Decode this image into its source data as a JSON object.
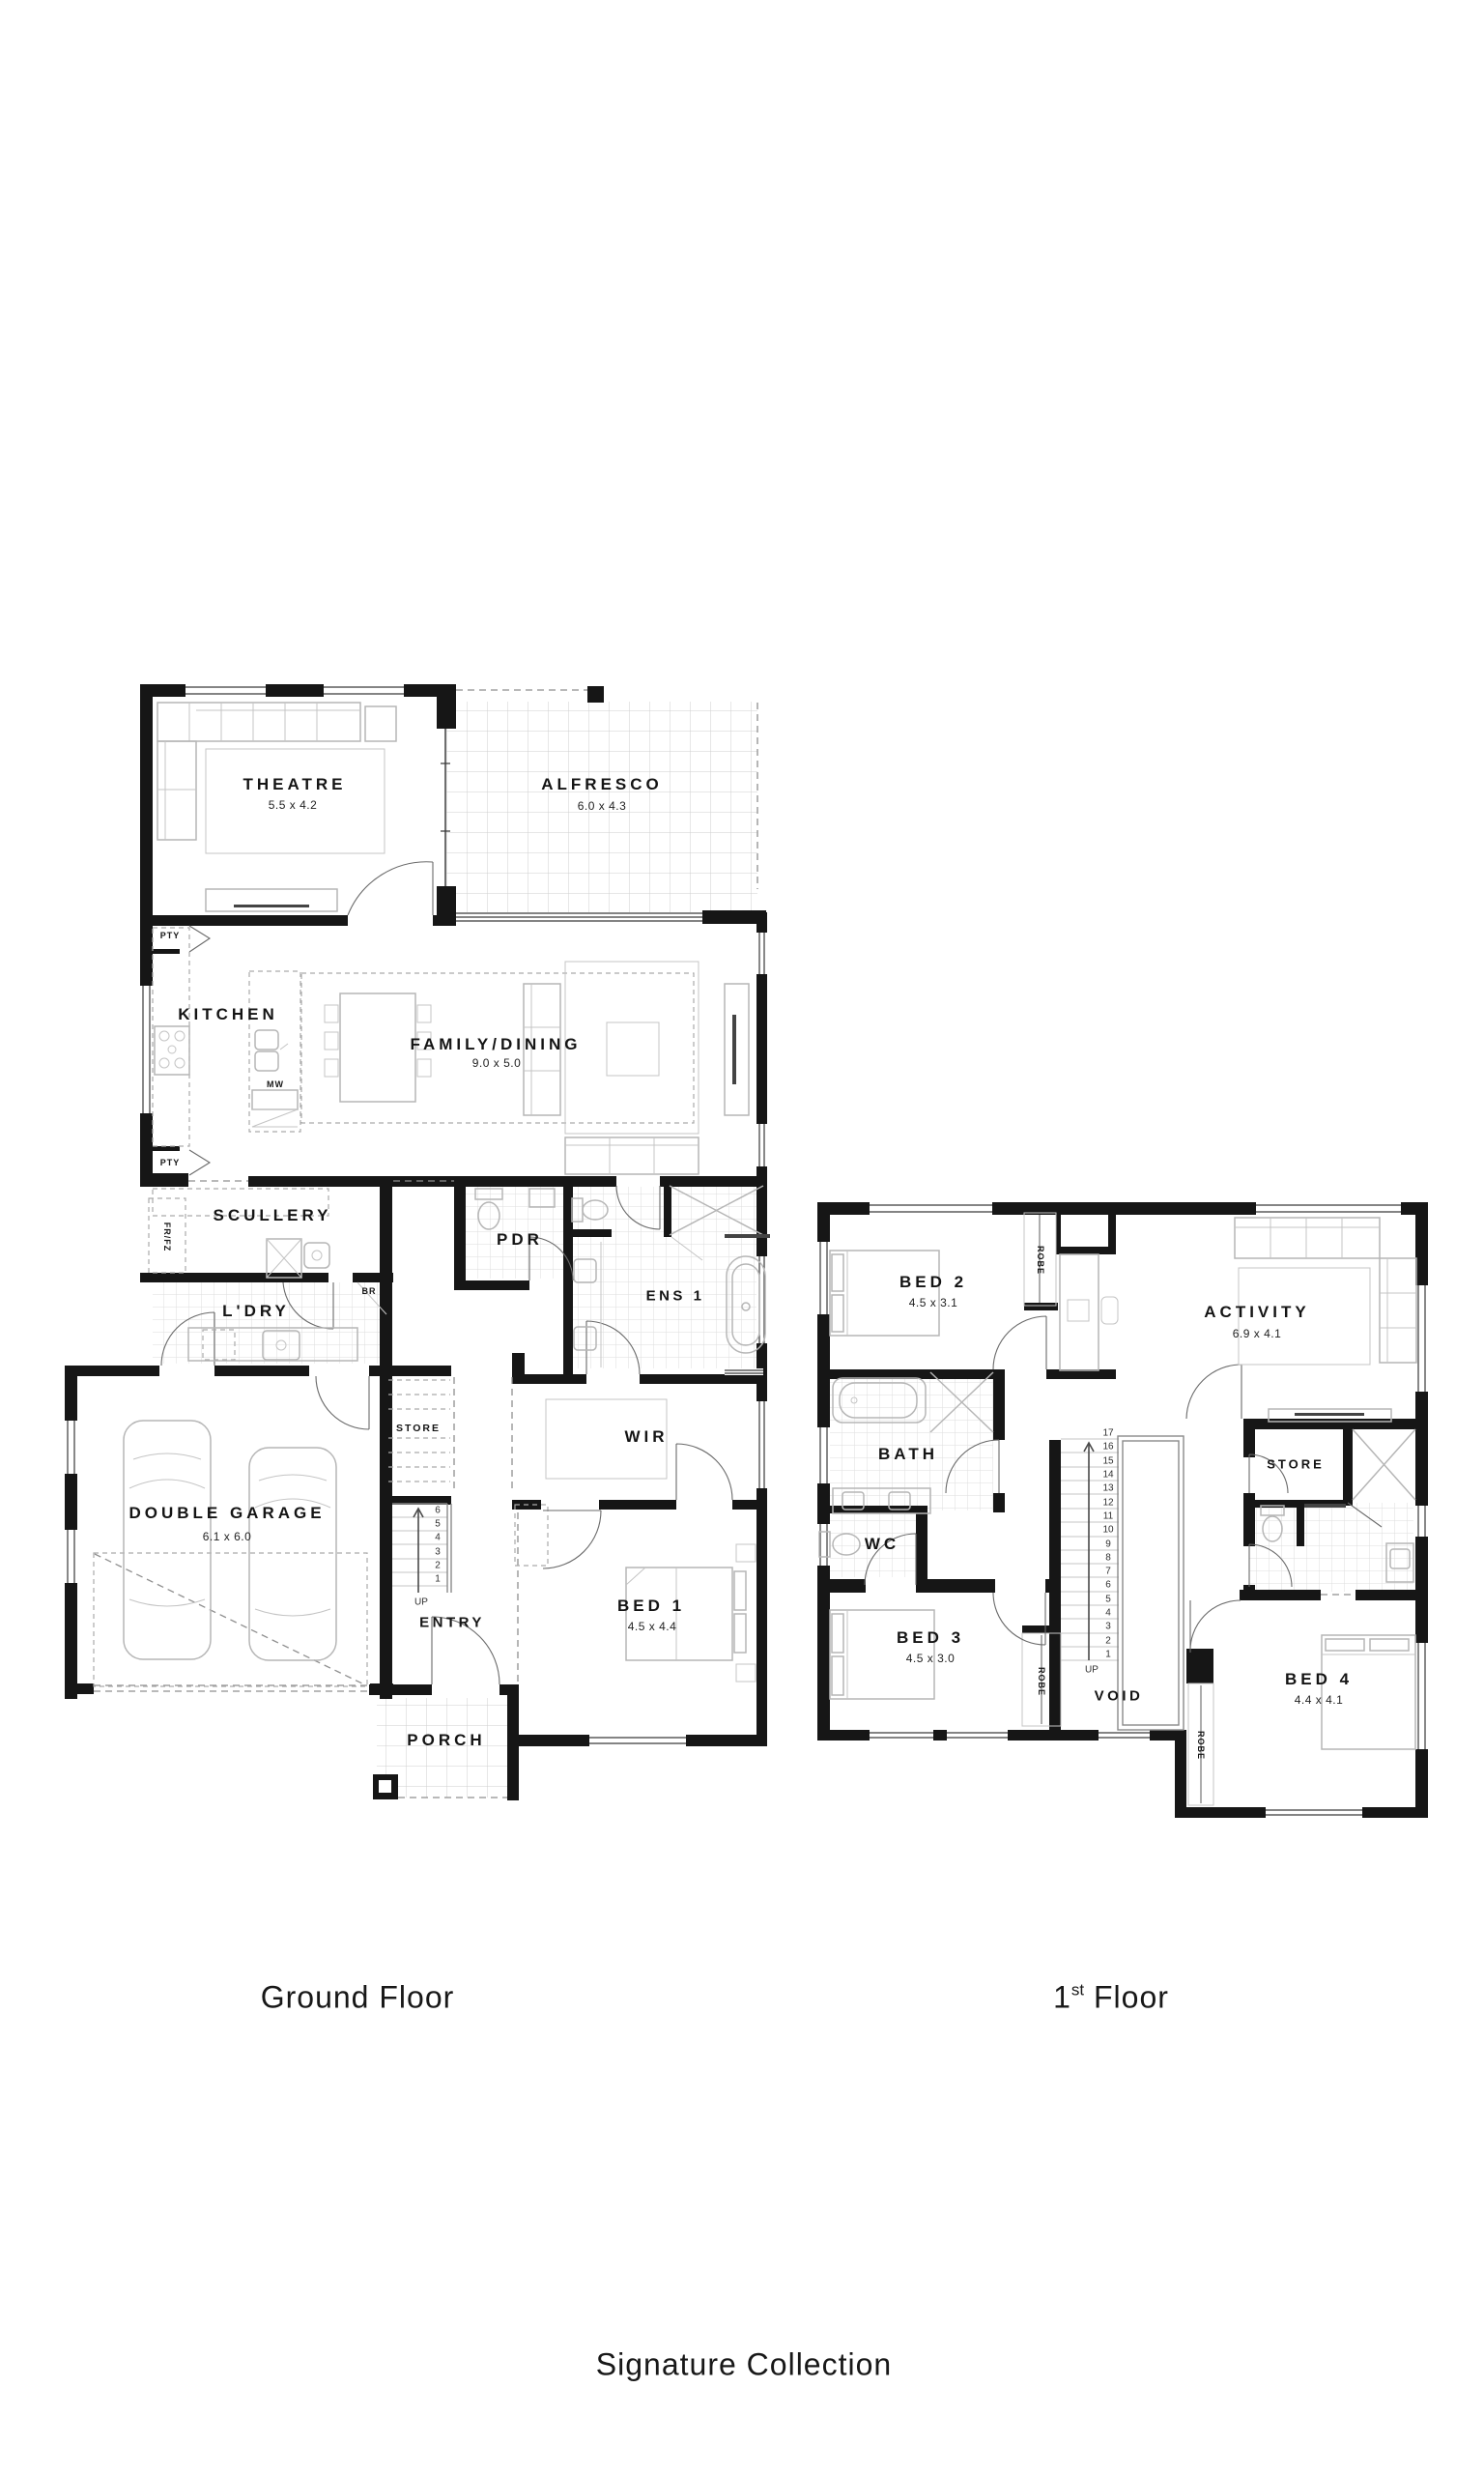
{
  "meta": {
    "background": "#ffffff",
    "ink": "#161616",
    "furniture_stroke": "#b6b6b6",
    "tile_stroke": "#dcdcdc"
  },
  "captions": {
    "ground": "Ground Floor",
    "first_num": "1",
    "first_sup": "st",
    "first_rest": " Floor",
    "collection": "Signature Collection"
  },
  "ground_floor": {
    "rooms": {
      "theatre": {
        "name": "THEATRE",
        "dim": "5.5 x 4.2"
      },
      "alfresco": {
        "name": "ALFRESCO",
        "dim": "6.0 x 4.3"
      },
      "kitchen": {
        "name": "KITCHEN"
      },
      "family_dining": {
        "name": "FAMILY/DINING",
        "dim": "9.0 x 5.0"
      },
      "scullery": {
        "name": "SCULLERY"
      },
      "pdr": {
        "name": "PDR"
      },
      "ens1": {
        "name": "ENS 1"
      },
      "ldry": {
        "name": "L'DRY"
      },
      "store": {
        "name": "STORE"
      },
      "wir": {
        "name": "WIR"
      },
      "garage": {
        "name": "DOUBLE GARAGE",
        "dim": "6.1 x 6.0"
      },
      "entry": {
        "name": "ENTRY"
      },
      "bed1": {
        "name": "BED 1",
        "dim": "4.5 x 4.4"
      },
      "porch": {
        "name": "PORCH"
      }
    },
    "small_labels": {
      "pty_top": "PTY",
      "pty_bottom": "PTY",
      "frfz": "FR/FZ",
      "br": "BR",
      "mw": "MW",
      "up": "UP"
    },
    "stairs": [
      "6",
      "5",
      "4",
      "3",
      "2",
      "1"
    ]
  },
  "first_floor": {
    "rooms": {
      "bed2": {
        "name": "BED 2",
        "dim": "4.5 x 3.1"
      },
      "activity": {
        "name": "ACTIVITY",
        "dim": "6.9 x 4.1"
      },
      "bath": {
        "name": "BATH"
      },
      "wc": {
        "name": "WC"
      },
      "store": {
        "name": "STORE"
      },
      "bed3": {
        "name": "BED 3",
        "dim": "4.5 x 3.0"
      },
      "void": {
        "name": "VOID"
      },
      "bed4": {
        "name": "BED 4",
        "dim": "4.4 x 4.1"
      }
    },
    "small_labels": {
      "robe_bed2": "ROBE",
      "robe_bed3": "ROBE",
      "robe_bed4": "ROBE",
      "up": "UP"
    },
    "stairs": [
      "17",
      "16",
      "15",
      "14",
      "13",
      "12",
      "11",
      "10",
      "9",
      "8",
      "7",
      "6",
      "5",
      "4",
      "3",
      "2",
      "1"
    ]
  }
}
